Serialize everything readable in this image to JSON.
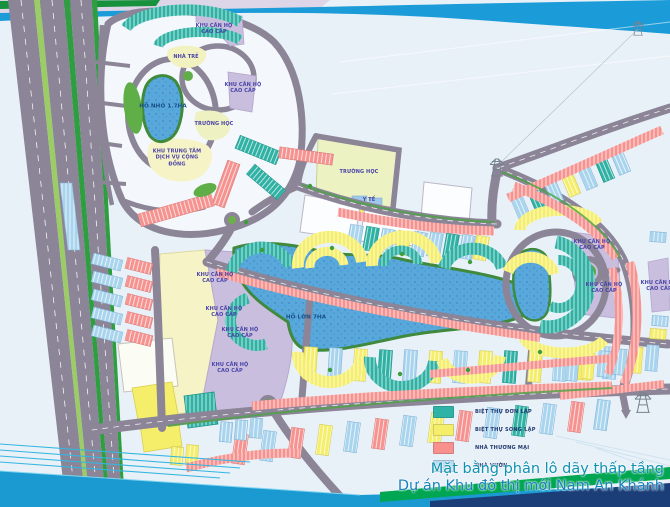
{
  "title": {
    "line1": "Mặt bằng phân lô dãy thấp tầng",
    "line2": "Dự án Khu đô thị mới Nam An Khánh"
  },
  "legend": {
    "items": [
      {
        "label": "BIỆT THỰ ĐƠN LẬP",
        "color": "#2fb3a7"
      },
      {
        "label": "BIỆT THỰ SONG LẬP",
        "color": "#f4ee6a"
      },
      {
        "label": "NHÀ THƯƠNG MẠI",
        "color": "#f8918e"
      },
      {
        "label": "NHÀ VƯỜN",
        "color": "#b5d8ee"
      }
    ]
  },
  "map": {
    "labels": [
      {
        "text": "KHU CĂN HỘ CAO CẤP",
        "x": 214,
        "y": 29
      },
      {
        "text": "NHÀ TRẺ",
        "x": 186,
        "y": 57
      },
      {
        "text": "KHU CĂN HỘ CAO CẤP",
        "x": 243,
        "y": 88
      },
      {
        "text": "HỒ NHỎ 1.7HA",
        "x": 163,
        "y": 107
      },
      {
        "text": "TRƯỜNG HỌC",
        "x": 214,
        "y": 124
      },
      {
        "text": "KHU TRUNG TÂM DỊCH VỤ CỘNG ĐỒNG",
        "x": 177,
        "y": 158
      },
      {
        "text": "TRƯỜNG HỌC",
        "x": 359,
        "y": 172
      },
      {
        "text": "Y TẾ",
        "x": 369,
        "y": 200
      },
      {
        "text": "KHU CĂN HỘ CAO CẤP",
        "x": 215,
        "y": 278
      },
      {
        "text": "KHU CĂN HỘ CAO CẤP",
        "x": 224,
        "y": 312
      },
      {
        "text": "KHU CĂN HỘ CAO CẤP",
        "x": 240,
        "y": 333
      },
      {
        "text": "KHU CĂN HỘ CAO CẤP",
        "x": 230,
        "y": 368
      },
      {
        "text": "HỒ LỚN 7HA",
        "x": 306,
        "y": 318
      },
      {
        "text": "KHU CĂN HỘ CAO CẤP",
        "x": 592,
        "y": 245
      },
      {
        "text": "KHU CĂN HỘ CAO CẤP",
        "x": 604,
        "y": 288
      },
      {
        "text": "KHU CĂN HỘ CAO CẤP",
        "x": 659,
        "y": 286
      }
    ]
  },
  "colors": {
    "detached_villa_teal": "#2fb3a7",
    "semi_detached_villa_yellow": "#f4ee6a",
    "commercial_house_pink": "#f8918e",
    "garden_house_blue": "#b5d8ee",
    "apartment_zone_purple": "#c9bedd",
    "lake_blue": "#58a8dc",
    "road_gray": "#8b8597",
    "river_band_blue": "#1b9cd8",
    "swoosh_cyan": "#1b9ad2",
    "swoosh_green": "#00a651",
    "swoosh_navy": "#1c3e78",
    "title_teal": "#0f93b2"
  }
}
